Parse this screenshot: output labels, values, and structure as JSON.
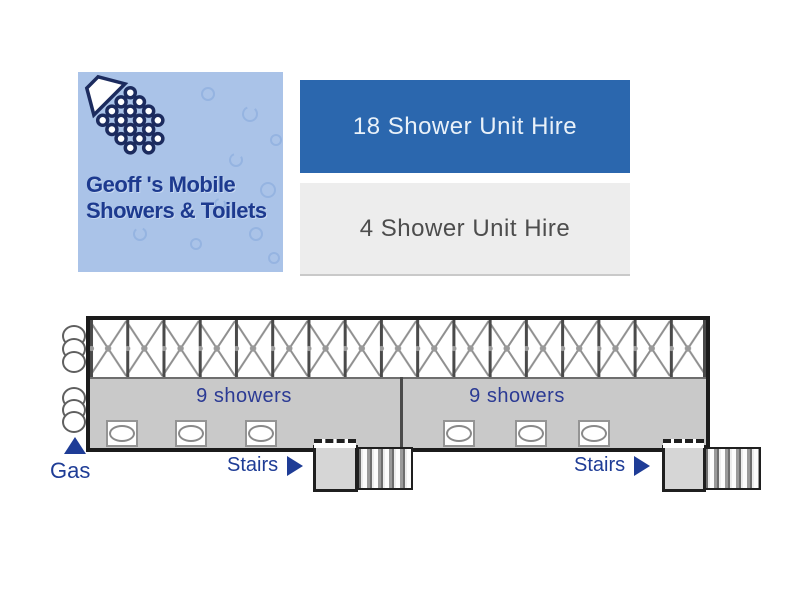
{
  "brand": {
    "title_line1": "Geoff 's Mobile",
    "title_line2": "Showers & Toilets"
  },
  "nav": {
    "primary_label": "18 Shower Unit Hire",
    "secondary_label": "4 Shower Unit Hire"
  },
  "diagram": {
    "section_left_label": "9 showers",
    "section_right_label": "9 showers",
    "gas_label": "Gas",
    "stairs_left_label": "Stairs",
    "stairs_right_label": "Stairs"
  },
  "colors": {
    "primary_blue": "#2b67ae",
    "secondary_gray": "#ededed",
    "navy_text": "#1e3c96",
    "logo_background": "#aac3e8",
    "logo_text": "#1d3a8f",
    "shower_area_gray": "#c9c9c9",
    "stairs_gray": "#d6d6d6"
  }
}
